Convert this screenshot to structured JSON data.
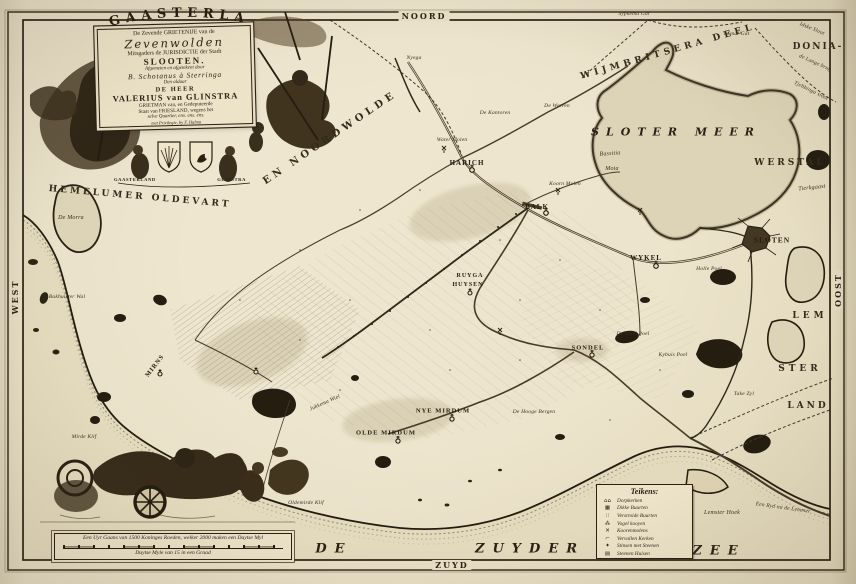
{
  "compass": {
    "north": "NOORD",
    "south": "ZUYD",
    "west": "WEST",
    "east": "OOST"
  },
  "cartouche": {
    "arc_title": "GAASTERLAND",
    "lines": [
      {
        "text": "De Zevende GRIETENIJE van de",
        "cls": "c-sm"
      },
      {
        "text": "Zevenwolden",
        "cls": "c-script"
      },
      {
        "text": "Mitsgaders de JURISDICTIE der Stadt",
        "cls": "c-sm"
      },
      {
        "text": "SLOOTEN.",
        "cls": "c-slooten"
      },
      {
        "text": "Afgemeten en afgetekent door",
        "cls": "c-tiny"
      },
      {
        "text": "B. Schotanus à Sterringa",
        "cls": "c-script2"
      },
      {
        "text": "Den aldaar",
        "cls": "c-tiny"
      },
      {
        "text": "DE HEER",
        "cls": "c-md"
      },
      {
        "text": "VALERIUS van GLINSTRA",
        "cls": "c-lg"
      },
      {
        "text": "GRIETMAN van, en Gedeputeerde",
        "cls": "c-tiny2"
      },
      {
        "text": "Staat van FRIESLAND, wegens het",
        "cls": "c-tiny2"
      },
      {
        "text": "selve Quartier, ens. ens. ens.",
        "cls": "c-tiny"
      },
      {
        "text": "met Privilegie, by F. Halma",
        "cls": "c-micro"
      }
    ],
    "ribbon_left": "GAASTERLAND",
    "ribbon_right": "GLINSTRA"
  },
  "scale_bar": {
    "line1": "Een Uyr Gaans van 1500 Koninges Roeden, welker 2000 maken een Duytse Myl",
    "line2": "Duytse Myle van 15 in een Graad"
  },
  "legend": {
    "title": "Teikens:",
    "items": [
      {
        "symbol": "church-pair-icon",
        "glyph": "⌂⌂",
        "label": "Dorpkerken"
      },
      {
        "symbol": "dense-buurt-icon",
        "glyph": "▦",
        "label": "Dikke Buurten"
      },
      {
        "symbol": "scattered-buurt-icon",
        "glyph": "∷",
        "label": "Verstroide Buurten"
      },
      {
        "symbol": "bird-decoy-icon",
        "glyph": "⁂",
        "label": "Vogel kooyen"
      },
      {
        "symbol": "windmill-icon",
        "glyph": "✕",
        "label": "Koorenmolens"
      },
      {
        "symbol": "ruined-church-icon",
        "glyph": "⌐",
        "label": "Vervallen Kerken"
      },
      {
        "symbol": "stins-icon",
        "glyph": "✦",
        "label": "Stinsen met Steenen"
      },
      {
        "symbol": "stone-house-icon",
        "glyph": "▤",
        "label": "Steenen Huisen"
      }
    ]
  },
  "colors": {
    "paper": "#e8dfc6",
    "ink": "#2b2214",
    "sea": "#e3d9bd",
    "lake": "#ddd3b6"
  },
  "labels": [
    {
      "name": "region-hemelumer-oldevart",
      "text": "HEMELUMER OLDEVART",
      "x": 140,
      "y": 197,
      "cls": "region",
      "rot": 5
    },
    {
      "name": "region-noordwolde",
      "text": "EN NOORDWOLDE",
      "x": 330,
      "y": 138,
      "cls": "region",
      "rot": -34,
      "ls": 4,
      "fs": 10
    },
    {
      "name": "region-wijmbritsera-deel",
      "text": "WIJMBRITSERA DEEL",
      "x": 668,
      "y": 52,
      "cls": "region",
      "rot": -16,
      "ls": 4
    },
    {
      "name": "region-donia",
      "text": "DONIA-",
      "x": 818,
      "y": 47,
      "cls": "region",
      "ls": 2
    },
    {
      "name": "region-werstal",
      "text": "WERSTAL",
      "x": 790,
      "y": 163,
      "cls": "region",
      "ls": 3
    },
    {
      "name": "region-lem",
      "text": "LEM",
      "x": 810,
      "y": 316,
      "cls": "region",
      "ls": 4
    },
    {
      "name": "region-ster",
      "text": "STER",
      "x": 800,
      "y": 369,
      "cls": "region",
      "ls": 4
    },
    {
      "name": "region-land",
      "text": "LAND",
      "x": 808,
      "y": 406,
      "cls": "region",
      "ls": 3
    },
    {
      "name": "label-tierkgaast",
      "text": "Tierkgaast",
      "x": 812,
      "y": 188,
      "cls": "minor",
      "rot": -6,
      "fs": 6
    },
    {
      "name": "lake-sloter-meer",
      "text": "SLOTER MEER",
      "x": 676,
      "y": 132,
      "cls": "lake"
    },
    {
      "name": "label-bassitia",
      "text": "Bassitia",
      "x": 610,
      "y": 154,
      "cls": "minor",
      "fs": 6,
      "rot": -4
    },
    {
      "name": "label-moia",
      "text": "Moia",
      "x": 612,
      "y": 169,
      "cls": "minor",
      "fs": 6
    },
    {
      "name": "sea-de",
      "text": "DE",
      "x": 334,
      "y": 549,
      "cls": "sea"
    },
    {
      "name": "sea-zuyder",
      "text": "ZUYDER",
      "x": 530,
      "y": 549,
      "cls": "sea"
    },
    {
      "name": "sea-zee",
      "text": "ZEE",
      "x": 719,
      "y": 551,
      "cls": "sea"
    },
    {
      "name": "town-harich",
      "text": "HARICH",
      "x": 467,
      "y": 163,
      "cls": "town"
    },
    {
      "name": "town-balk",
      "text": "BALK",
      "x": 537,
      "y": 207,
      "cls": "town"
    },
    {
      "name": "town-wykel",
      "text": "WYKEL",
      "x": 646,
      "y": 258,
      "cls": "town"
    },
    {
      "name": "town-sloten",
      "text": "SLOTEN",
      "x": 772,
      "y": 240,
      "cls": "town",
      "fs": 7.5
    },
    {
      "name": "town-sondel",
      "text": "SONDEL",
      "x": 588,
      "y": 348,
      "cls": "town",
      "fs": 6.5
    },
    {
      "name": "town-nye-mirdum",
      "text": "NYE MIRDUM",
      "x": 443,
      "y": 411,
      "cls": "town",
      "fs": 6.5
    },
    {
      "name": "town-olde-mirdum",
      "text": "OLDE MIRDUM",
      "x": 386,
      "y": 433,
      "cls": "town",
      "fs": 6.5
    },
    {
      "name": "town-ruyga",
      "text": "RUYGA",
      "x": 470,
      "y": 276,
      "cls": "town",
      "fs": 6
    },
    {
      "name": "town-huysen",
      "text": "HUYSEN",
      "x": 468,
      "y": 285,
      "cls": "town",
      "fs": 6
    },
    {
      "name": "town-mirns",
      "text": "MIRNS",
      "x": 155,
      "y": 366,
      "cls": "town",
      "rot": -52,
      "fs": 6.5
    },
    {
      "name": "label-nyega",
      "text": "Nyega",
      "x": 414,
      "y": 58,
      "cls": "minor"
    },
    {
      "name": "label-de-morra",
      "text": "De Morra",
      "x": 71,
      "y": 218,
      "cls": "minor",
      "fs": 6
    },
    {
      "name": "label-bakhuister-wal",
      "text": "Bakhuister Wal",
      "x": 67,
      "y": 297,
      "cls": "minor"
    },
    {
      "name": "label-de-kantoren",
      "text": "De Kantoren",
      "x": 495,
      "y": 113,
      "cls": "minor"
    },
    {
      "name": "label-de-warren",
      "text": "De Warren",
      "x": 557,
      "y": 106,
      "cls": "minor"
    },
    {
      "name": "label-water-molen",
      "text": "Water Molen",
      "x": 452,
      "y": 140,
      "cls": "minor"
    },
    {
      "name": "label-koorn-molen",
      "text": "Koorn Molen",
      "x": 565,
      "y": 184,
      "cls": "minor"
    },
    {
      "name": "label-holle-poel",
      "text": "Holle Poel",
      "x": 709,
      "y": 269,
      "cls": "minor"
    },
    {
      "name": "label-zand-poel",
      "text": "De Zand Poel",
      "x": 633,
      "y": 334,
      "cls": "minor"
    },
    {
      "name": "label-kybuis-poel",
      "text": "Kybuis Poel",
      "x": 673,
      "y": 355,
      "cls": "minor"
    },
    {
      "name": "label-jukkema-wiel",
      "text": "Jukkema Wiel",
      "x": 325,
      "y": 403,
      "cls": "minor",
      "rot": -24
    },
    {
      "name": "label-hooge-bergen",
      "text": "De Hooge Bergen",
      "x": 534,
      "y": 412,
      "cls": "minor"
    },
    {
      "name": "label-oldemirde-klif",
      "text": "Oldemirde Klif",
      "x": 306,
      "y": 503,
      "cls": "minor"
    },
    {
      "name": "label-mirde-klif",
      "text": "Mirde Klif",
      "x": 84,
      "y": 437,
      "cls": "minor"
    },
    {
      "name": "label-lemster-hoek",
      "text": "Lemster Hoek",
      "x": 722,
      "y": 513,
      "cls": "minor",
      "fs": 6
    },
    {
      "name": "label-ryd-na-lemmer",
      "text": "Een Ryd na de Lemmer",
      "x": 783,
      "y": 508,
      "cls": "minor",
      "rot": 8
    },
    {
      "name": "label-take-zyl",
      "text": "Take Zyl",
      "x": 744,
      "y": 394,
      "cls": "minor"
    },
    {
      "name": "label-sypkema-gat",
      "text": "Sypkema Gat",
      "x": 634,
      "y": 14,
      "cls": "minor"
    },
    {
      "name": "label-smal-gat",
      "text": "'t Smal Gat",
      "x": 736,
      "y": 34,
      "cls": "minor"
    },
    {
      "name": "label-idske-sloot",
      "text": "Idske Sloot",
      "x": 812,
      "y": 29,
      "cls": "minor",
      "rot": 22
    },
    {
      "name": "label-lange-brug",
      "text": "de Lange brug",
      "x": 815,
      "y": 63,
      "cls": "minor",
      "rot": 24
    },
    {
      "name": "label-tjebbinga-sloot",
      "text": "Tjebbinga sloot",
      "x": 811,
      "y": 91,
      "cls": "minor",
      "rot": 26
    }
  ]
}
